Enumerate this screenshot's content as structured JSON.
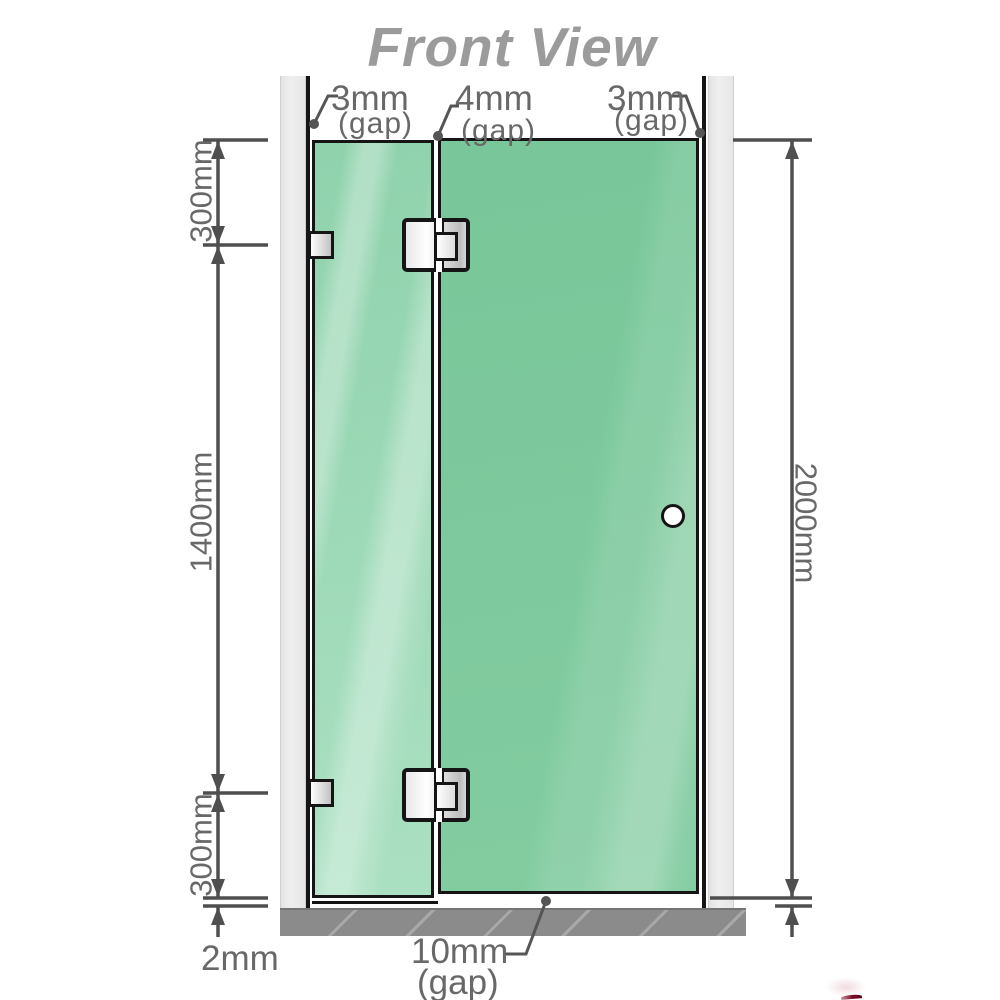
{
  "title": "Front View",
  "dimensions": {
    "gap_left": {
      "value": "3mm",
      "suffix": "(gap)"
    },
    "gap_middle": {
      "value": "4mm",
      "suffix": "(gap)"
    },
    "gap_right": {
      "value": "3mm",
      "suffix": "(gap)"
    },
    "segment_top": "300mm",
    "segment_middle": "1400mm",
    "segment_bottom": "300mm",
    "total_height": "2000mm",
    "floor_clearance": "2mm",
    "door_floor_gap": {
      "value": "10mm",
      "suffix": "(gap)"
    }
  },
  "colors": {
    "glass_green": "#7cc89d",
    "glass_green_light": "#abe0c2",
    "wall_gray": "#eaeaea",
    "floor_gray": "#8b8b8b",
    "dimension_line": "#4f4f4f",
    "label_text": "#686868",
    "title_text": "#9b9b9b",
    "outline_black": "#151515",
    "hinge_metal": "#d9d9d9",
    "logo_red": "#7c0a26"
  }
}
